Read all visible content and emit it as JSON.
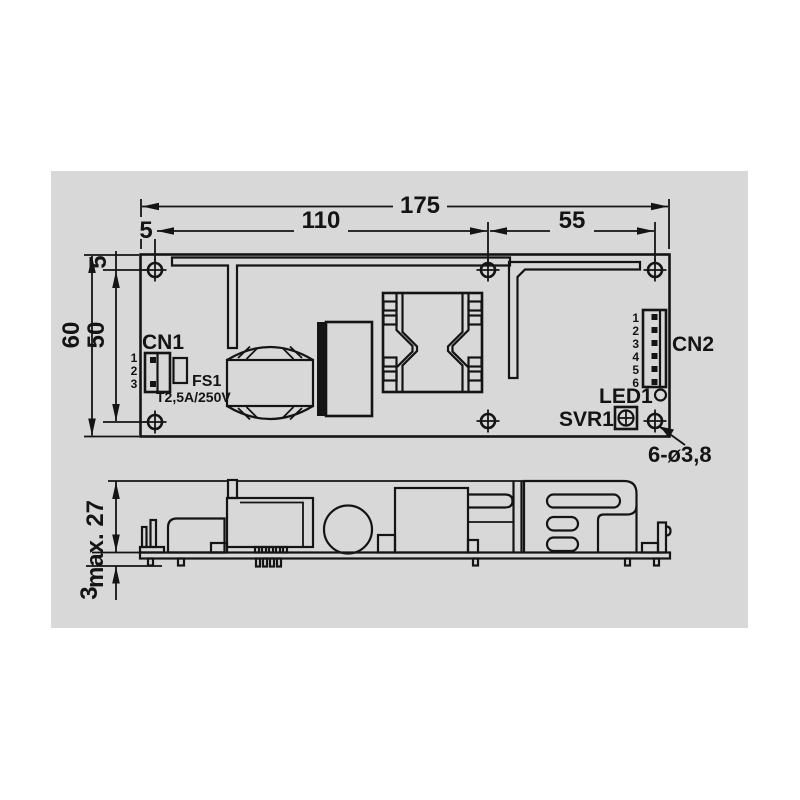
{
  "colors": {
    "panel_bg": "#d8d8d8",
    "ink": "#141414"
  },
  "top_view": {
    "dim_total_width": "175",
    "dim_edge_to_hole": "5",
    "dim_hole_span_left": "110",
    "dim_hole_span_right": "55",
    "dim_total_height": "60",
    "dim_hole_span_vertical": "50",
    "dim_top_edge_to_hole": "5",
    "cn1_label": "CN1",
    "cn1_pins": [
      "1",
      "2",
      "3"
    ],
    "fs1_label": "FS1",
    "fs1_rating": "T2,5A/250V",
    "cn2_label": "CN2",
    "cn2_pins": [
      "1",
      "2",
      "3",
      "4",
      "5",
      "6"
    ],
    "led_label": "LED1",
    "svr_label": "SVR1",
    "mounting_holes_note": "6-ø3,8"
  },
  "side_view": {
    "dim_max_height": "max. 27",
    "dim_pin_protrusion": "3"
  }
}
